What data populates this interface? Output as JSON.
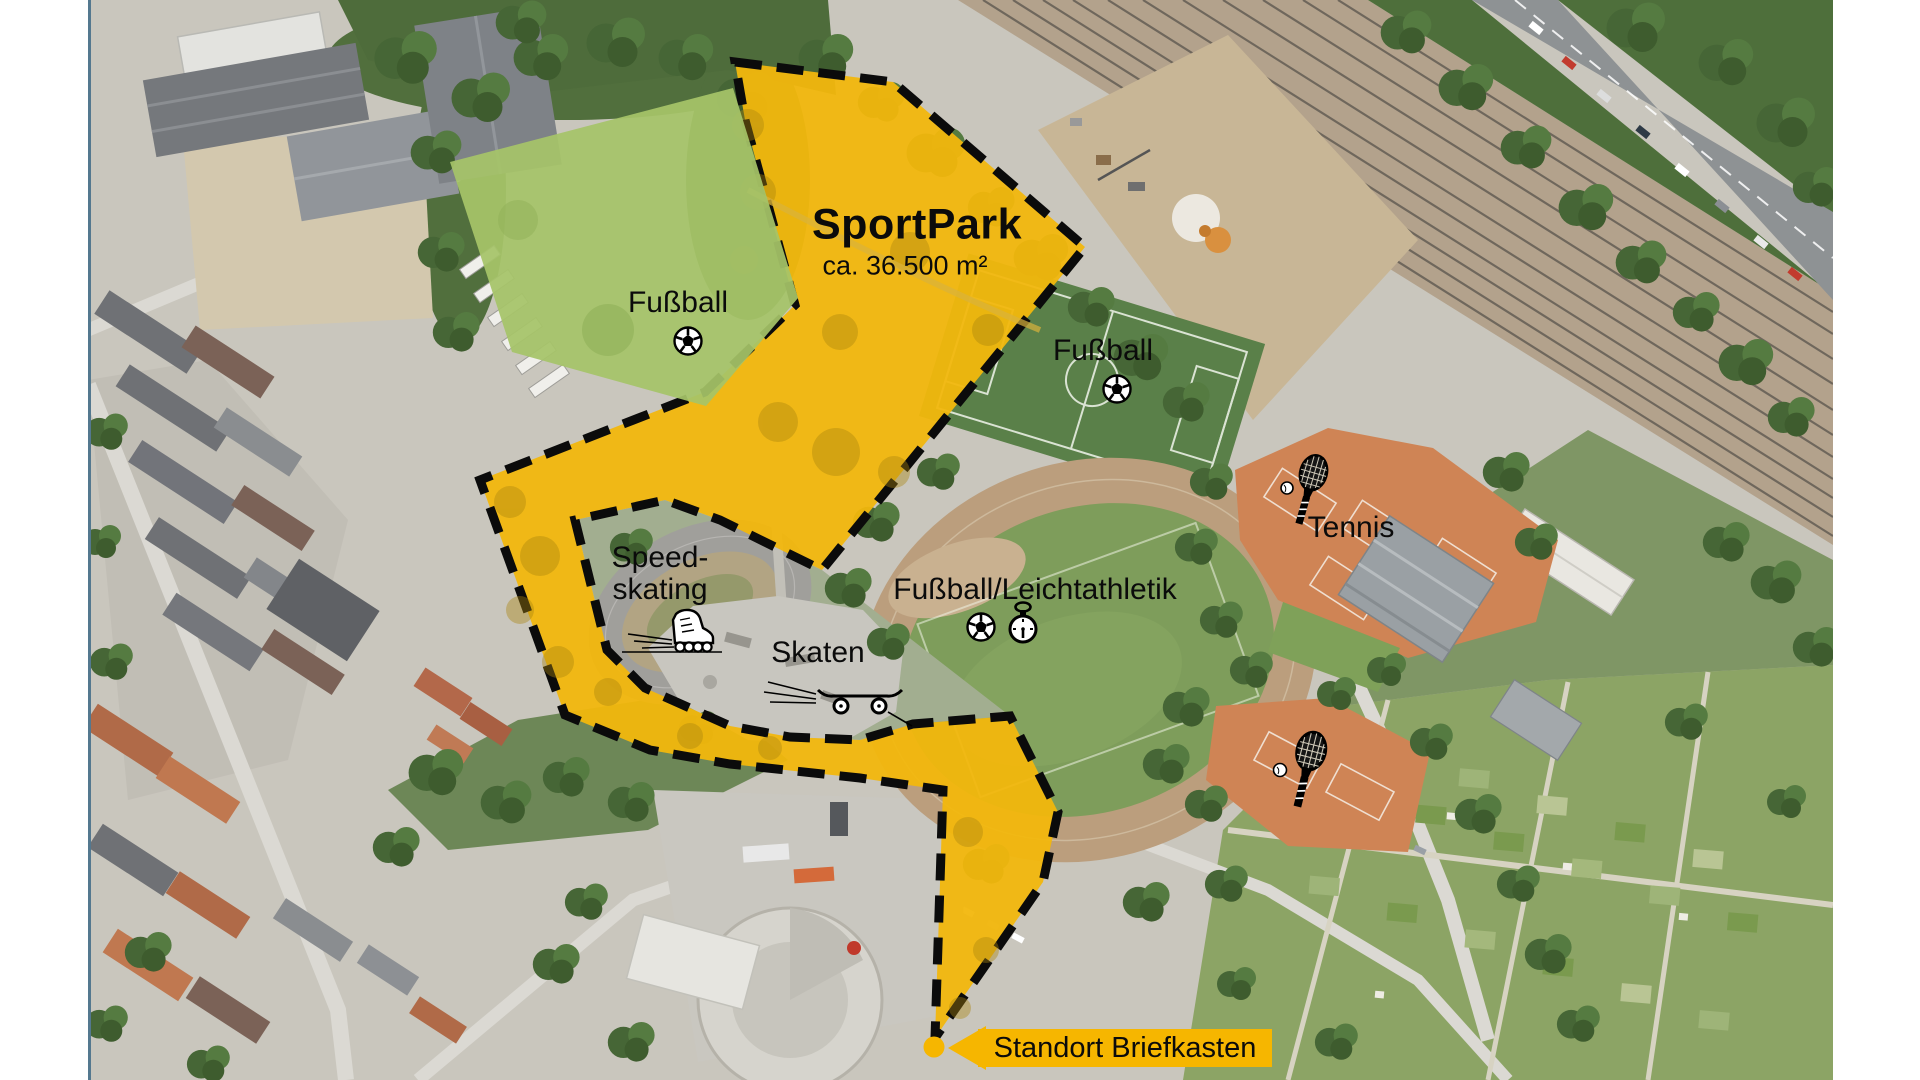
{
  "title": {
    "name": "SportPark",
    "area": "ca. 36.500 m²"
  },
  "site_labels": {
    "field_west": "Fußball",
    "field_east": "Fußball",
    "speedskating": [
      "Speed-",
      "skating"
    ],
    "skate": "Skaten",
    "stadium": "Fußball/Leichtathletik",
    "tennis": "Tennis"
  },
  "callout": {
    "mailbox_location": "Standort Briefkasten"
  },
  "icons": [
    "soccer-ball-icon",
    "stopwatch-icon",
    "inline-skate-icon",
    "skateboard-icon",
    "tennis-racket-icon",
    "location-dot",
    "arrow-left-icon"
  ],
  "colors": {
    "highlight_area": "#f2b70d",
    "field_highlight": "#a6c468",
    "callout_bg": "#f6b600",
    "dashed_border": "#0b0b0b",
    "clay_court": "#cf8455",
    "track": "#bb9e7d"
  }
}
